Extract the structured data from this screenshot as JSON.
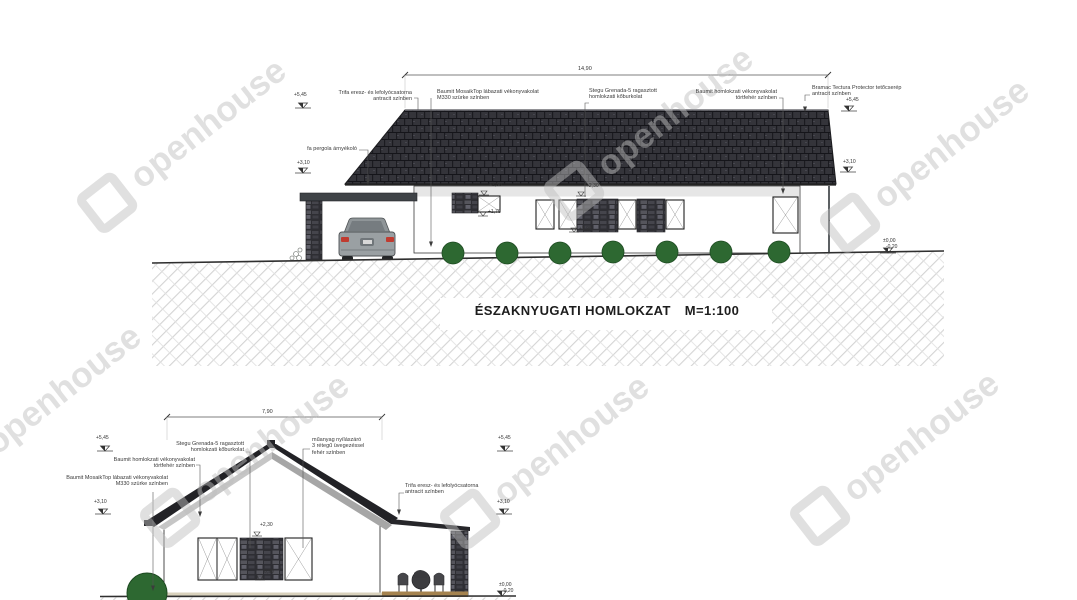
{
  "watermark": {
    "text": "openhouse"
  },
  "top": {
    "title": "ÉSZAKNYUGATI HOMLOKZAT",
    "scale": "M=1:100",
    "dim": "14,90",
    "ann_gutter": {
      "l1": "Trifa eresz- és lefolyócsatorna",
      "l2": "antracit színben"
    },
    "ann_plinth": {
      "l1": "Baumit MosaikTop lábazati vékonyvakolat",
      "l2": "M330 szürke színben"
    },
    "ann_stone": {
      "l1": "Stegu Grenada-5 ragasztott",
      "l2": "homlokzati kőburkolat"
    },
    "ann_render": {
      "l1": "Baumit homlokzati vékonyvakolat",
      "l2": "törtfehér színben"
    },
    "ann_roof": {
      "l1": "Bramac Tectura Protector tetőcserép",
      "l2": "antracit színben"
    },
    "ann_pergola": "fa pergola árnyékoló",
    "levels": {
      "ridge_left": "+5,45",
      "pergola": "+3,10",
      "ridge_right": "+5,45",
      "eave_right": "+3,10",
      "ground_zero": "±0,00",
      "ground_minus": "-0,20",
      "win1_top": "+2,50",
      "win1_sill": "+1,70",
      "win2_top": "+2,30",
      "win2_sill": "+1,90"
    }
  },
  "bottom": {
    "dim": "7,90",
    "ann_stone": {
      "l1": "Stegu Grenada-5 ragasztott",
      "l2": "homlokzati kőburkolat"
    },
    "ann_render": {
      "l1": "Baumit homlokzati vékonyvakolat",
      "l2": "törtfehér színben"
    },
    "ann_plinth": {
      "l1": "Baumit MosaikTop lábazati vékonyvakolat",
      "l2": "M330 szürke színben"
    },
    "ann_window": {
      "l1": "műanyag nyílászáró",
      "l2": "3 rétegű üvegezéssel",
      "l3": "fehér színben"
    },
    "ann_gutter": {
      "l1": "Trifa eresz- és lefolyócsatorna",
      "l2": "antracit színben"
    },
    "levels": {
      "ridge_left": "+5,45",
      "mid_left": "+3,10",
      "ridge_right": "+5,45",
      "mid_right": "+3,10",
      "ground_zero": "±0,00",
      "ground_minus": "-0,20",
      "win_top": "+2,30",
      "win_sill": "0,90"
    }
  },
  "colors": {
    "roof_tile": "#34343a",
    "stone": "#3c3c40",
    "bush_green": "#2d6831",
    "terrace_wood": "#a5834f",
    "line": "#3c3c3c",
    "watermark_gray": "#bebebe"
  }
}
